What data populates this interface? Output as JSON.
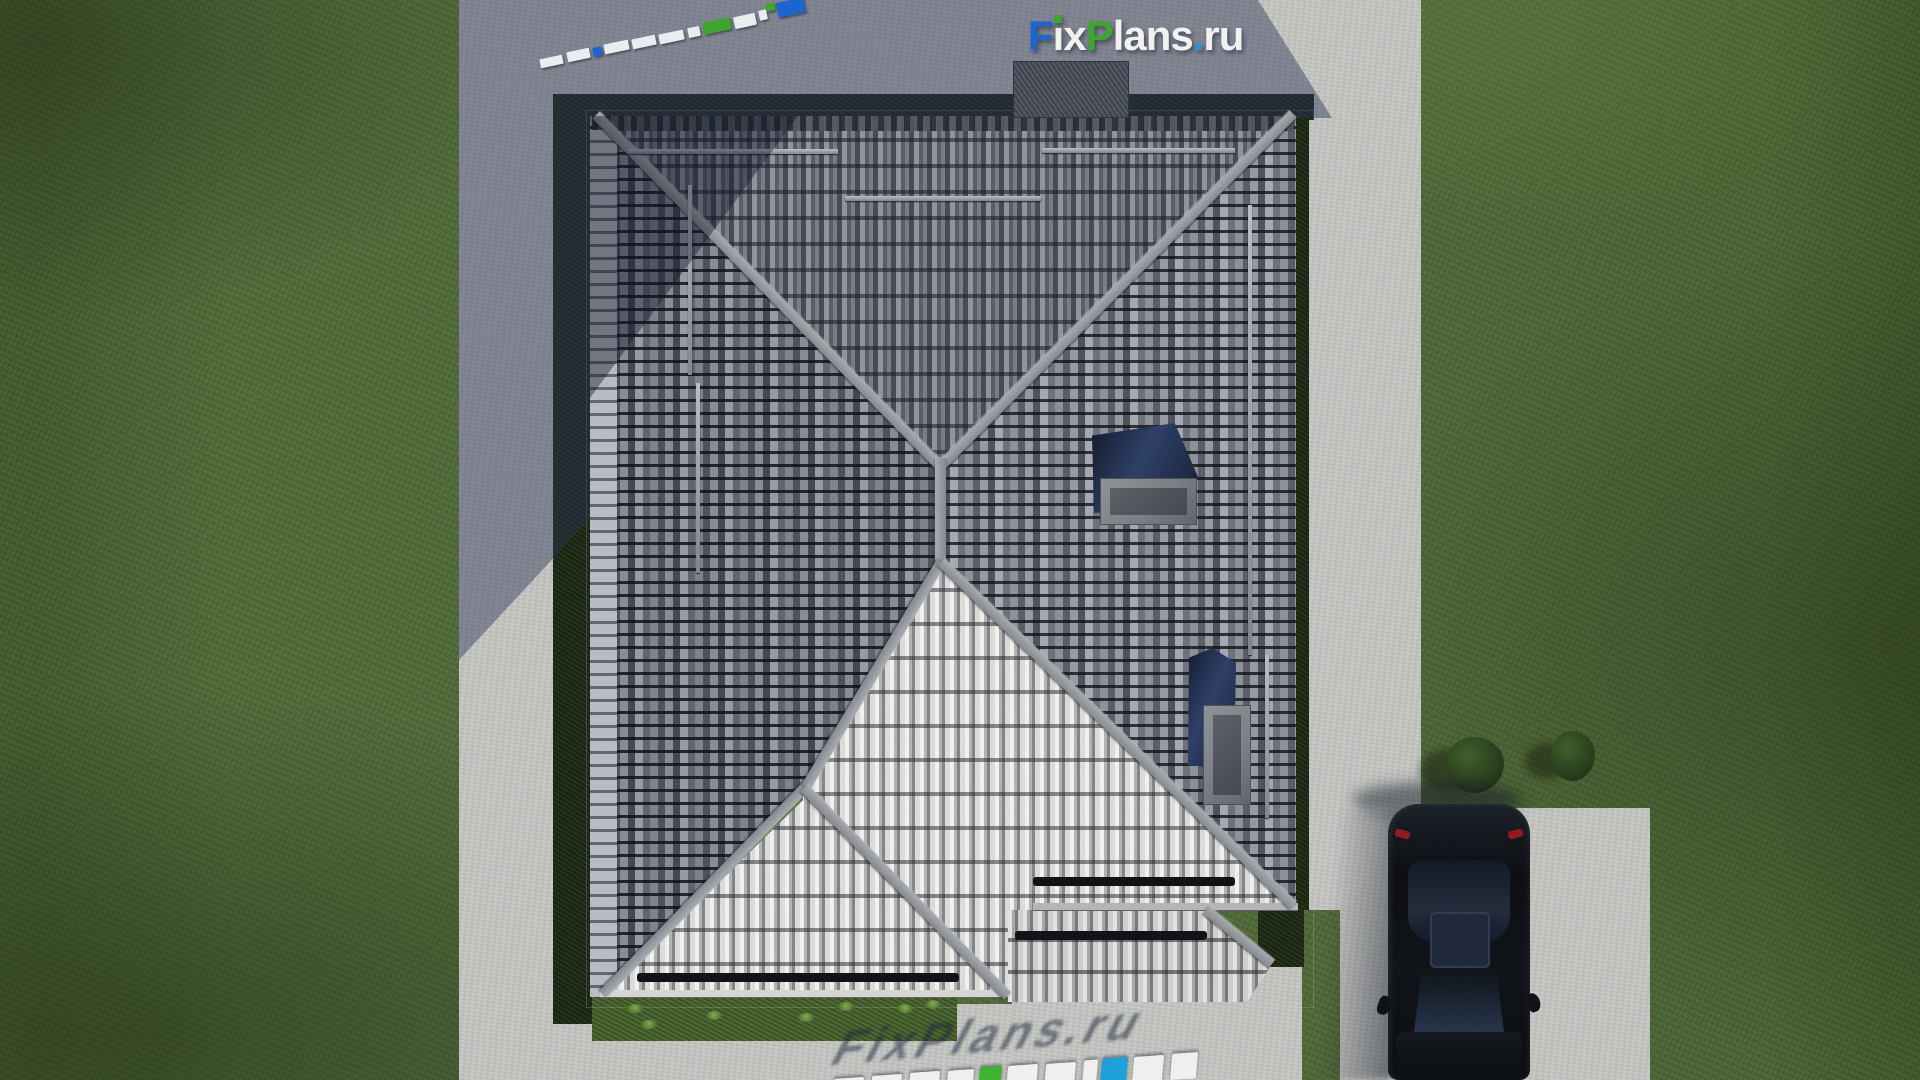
{
  "site": {
    "brand": "FixPlans.ru",
    "watermark_text": "FixPlans.ru",
    "logo_segments": [
      {
        "ch": "F",
        "color": "#1563cf"
      },
      {
        "ch": "ı",
        "color": "#f3f3f1",
        "dot": "#38a42b"
      },
      {
        "ch": "x",
        "color": "#f3f3f1"
      },
      {
        "ch": "P",
        "color": "#38a42b"
      },
      {
        "ch": "l",
        "color": "#f3f3f1"
      },
      {
        "ch": "a",
        "color": "#f3f3f1"
      },
      {
        "ch": "n",
        "color": "#f3f3f1"
      },
      {
        "ch": "s",
        "color": "#f3f3f1"
      },
      {
        "ch": ".",
        "color": "#1e97d8"
      },
      {
        "ch": "r",
        "color": "#f3f3f1"
      },
      {
        "ch": "u",
        "color": "#f3f3f1"
      }
    ]
  },
  "colors": {
    "grass": "#50693a",
    "concrete_light": "#c6c7c3",
    "cast_shadow": "rgba(39,46,82,0.44)",
    "dark_lawn": "#1b2712",
    "roof_dark": "#5d626d",
    "roof_bright": "#e9e9e7",
    "ridge": "#8f9297",
    "gutter": "#0b0d12",
    "skylight_glass": "#1a2947",
    "car_body": "#0b0d11",
    "logo_blue": "#1563cf",
    "logo_green": "#38a42b",
    "logo_dot_blue": "#1e97d8"
  },
  "scene": {
    "ruler_segments": [
      {
        "x": 540,
        "y": 57,
        "w": 23,
        "h": 9,
        "c": "#eceff2"
      },
      {
        "x": 567,
        "y": 50,
        "w": 23,
        "h": 10,
        "c": "#eceff2"
      },
      {
        "x": 593,
        "y": 47,
        "w": 9,
        "h": 9,
        "c": "#1563cf"
      },
      {
        "x": 604,
        "y": 42,
        "w": 25,
        "h": 10,
        "c": "#eceff2"
      },
      {
        "x": 632,
        "y": 37,
        "w": 24,
        "h": 10,
        "c": "#eceff2"
      },
      {
        "x": 659,
        "y": 32,
        "w": 25,
        "h": 10,
        "c": "#eceff2"
      },
      {
        "x": 688,
        "y": 27,
        "w": 12,
        "h": 10,
        "c": "#eceff2"
      },
      {
        "x": 703,
        "y": 20,
        "w": 28,
        "h": 12,
        "c": "#38a42b"
      },
      {
        "x": 734,
        "y": 15,
        "w": 22,
        "h": 12,
        "c": "#eceff2"
      },
      {
        "x": 759,
        "y": 10,
        "w": 8,
        "h": 10,
        "c": "#eceff2"
      },
      {
        "x": 766,
        "y": 3,
        "w": 9,
        "h": 8,
        "c": "#38a42b"
      },
      {
        "x": 777,
        "y": 0,
        "w": 28,
        "h": 15,
        "c": "#1563cf"
      }
    ],
    "slab_segments": [
      {
        "x": 833,
        "w": 30,
        "c": "#f1f1ef"
      },
      {
        "x": 871,
        "w": 30,
        "c": "#f1f1ef"
      },
      {
        "x": 909,
        "w": 30,
        "c": "#f1f1ef"
      },
      {
        "x": 947,
        "w": 26,
        "c": "#f1f1ef"
      },
      {
        "x": 979,
        "w": 22,
        "c": "#3bb32e"
      },
      {
        "x": 1007,
        "w": 30,
        "c": "#f1f1ef"
      },
      {
        "x": 1045,
        "w": 30,
        "c": "#f1f1ef"
      },
      {
        "x": 1083,
        "w": 14,
        "c": "#f1f1ef"
      },
      {
        "x": 1101,
        "w": 26,
        "c": "#18a0dc"
      },
      {
        "x": 1133,
        "w": 30,
        "c": "#f1f1ef"
      },
      {
        "x": 1171,
        "w": 26,
        "c": "#f1f1ef"
      }
    ],
    "snow_rails": [
      {
        "x": 628,
        "y": 149,
        "w": 210,
        "h": 5
      },
      {
        "x": 845,
        "y": 196,
        "w": 196,
        "h": 5
      },
      {
        "x": 1042,
        "y": 148,
        "w": 193,
        "h": 5
      },
      {
        "x": 688,
        "y": 185,
        "w": 4,
        "h": 190
      },
      {
        "x": 696,
        "y": 383,
        "w": 4,
        "h": 190
      },
      {
        "x": 1248,
        "y": 205,
        "w": 4,
        "h": 450
      },
      {
        "x": 1265,
        "y": 655,
        "w": 4,
        "h": 163
      }
    ],
    "gutters": [
      {
        "x": 637,
        "y": 973,
        "w": 322,
        "h": 9
      },
      {
        "x": 1033,
        "y": 877,
        "w": 202,
        "h": 9
      },
      {
        "x": 1015,
        "y": 931,
        "w": 192,
        "h": 9
      }
    ],
    "tufts": [
      {
        "x": 627,
        "y": 1004
      },
      {
        "x": 706,
        "y": 1011
      },
      {
        "x": 798,
        "y": 1013
      },
      {
        "x": 838,
        "y": 1002
      },
      {
        "x": 897,
        "y": 1004
      },
      {
        "x": 925,
        "y": 1000
      },
      {
        "x": 641,
        "y": 1020
      }
    ],
    "bushes": [
      {
        "x": 1446,
        "y": 737,
        "w": 58,
        "h": 56
      },
      {
        "x": 1551,
        "y": 731,
        "w": 44,
        "h": 50
      }
    ]
  }
}
